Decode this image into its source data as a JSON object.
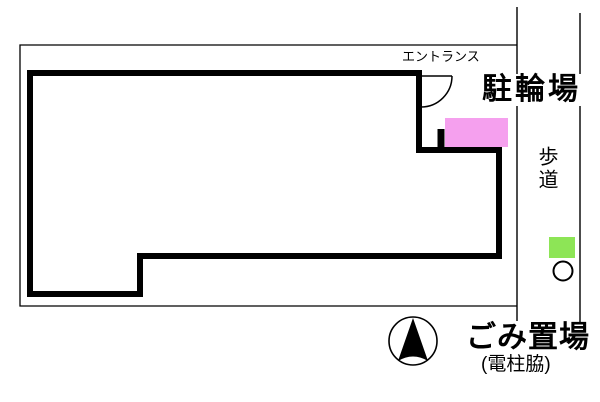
{
  "plan": {
    "entrance_label": "エントランス",
    "bicycle_parking_label": "駐輪場",
    "sidewalk_label": "歩道",
    "garbage_area_label": "ごみ置場",
    "garbage_area_note": "(電柱脇)"
  },
  "colors": {
    "bicycle_area_fill": "#f5a0ee",
    "garbage_marker_fill": "#8de556",
    "line_color": "#000000",
    "background": "#ffffff"
  }
}
